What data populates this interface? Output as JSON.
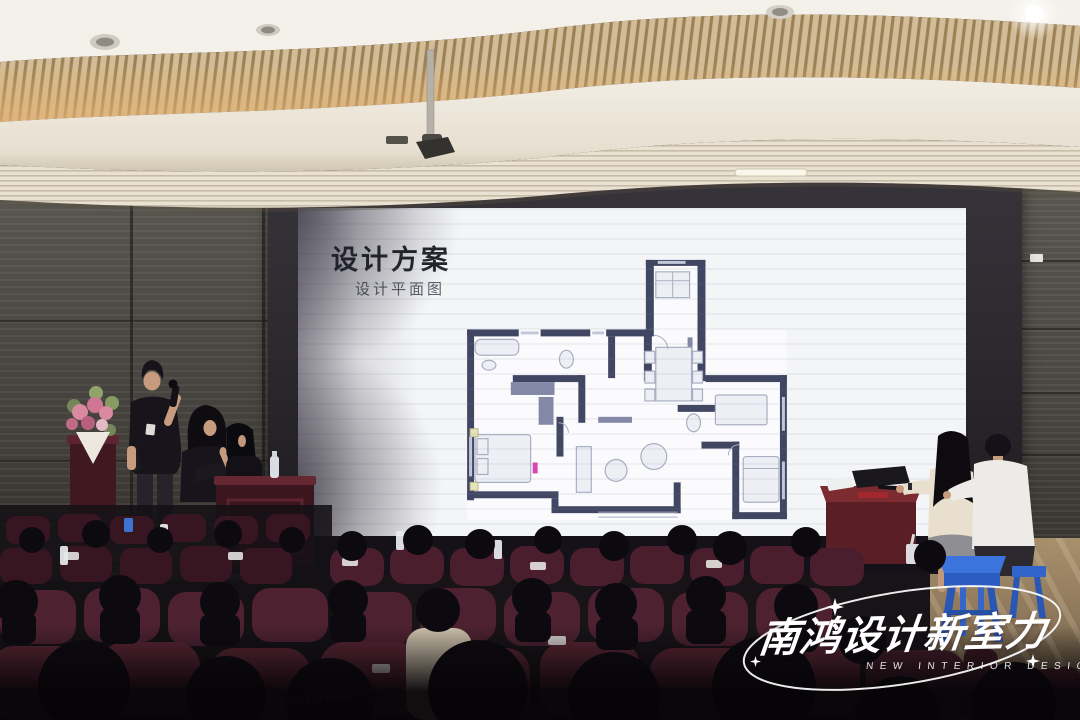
{
  "slide": {
    "title": "设计方案",
    "subtitle": "设计平面图"
  },
  "watermark": {
    "title": "南鸿设计新室力",
    "subtitle": "NEW INTERIOR DESIGN"
  },
  "audience": {
    "cap_print": "A JOTU"
  },
  "colors": {
    "screen_white": "#f4f5f7",
    "seat_maroon": "#4a1e2c",
    "stool_blue": "#3a74dc",
    "desk_red": "#5a1f24",
    "wall_gray": "#4a4843",
    "ceiling_glow": "#e3b275",
    "plan_wall": "#414663",
    "accent_magenta": "#d944b5"
  }
}
